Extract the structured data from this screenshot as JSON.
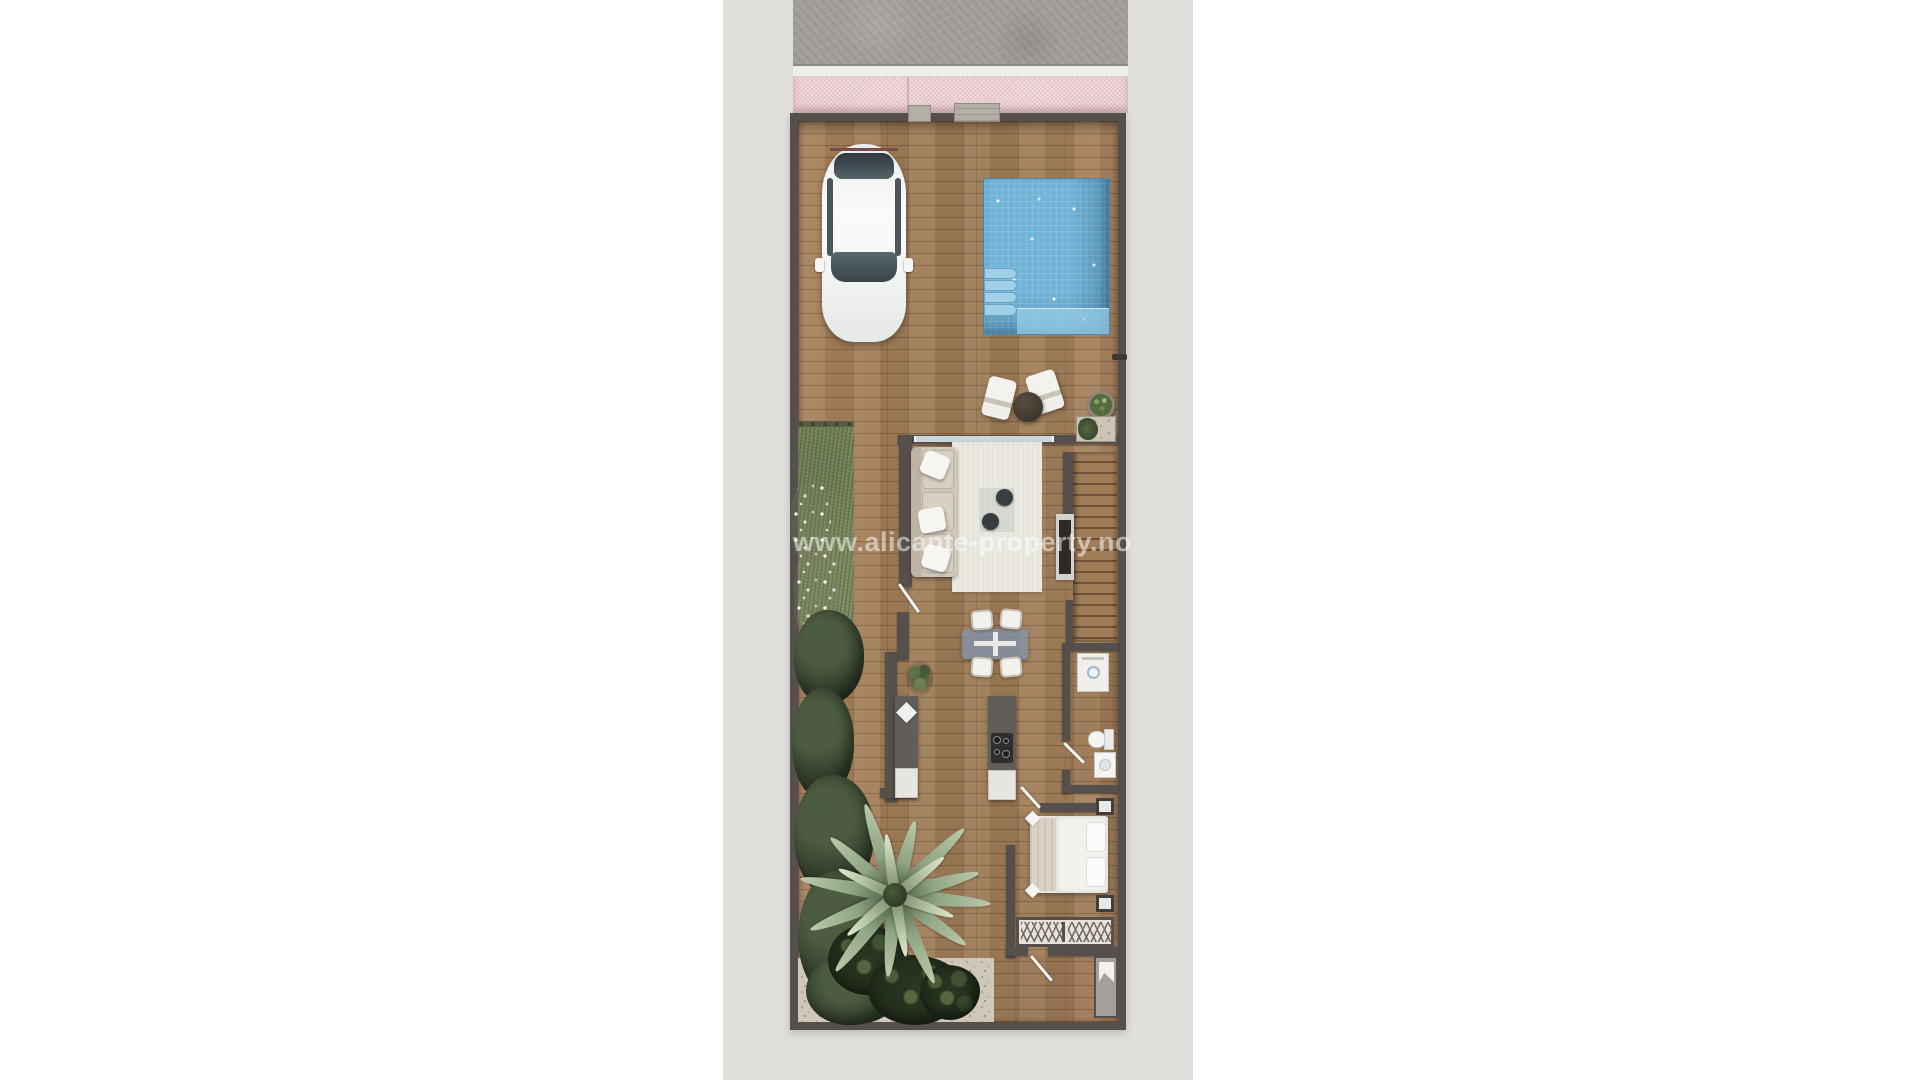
{
  "watermark": {
    "text": "www.alicante-property.no"
  },
  "colors": {
    "page_background": "#ffffff",
    "ground_strip": "#e1dfdb",
    "sidewalk_concrete": "#a29e99",
    "awning_pink": "#f3dfe3",
    "wall_dark": "#56504c",
    "deck_wood": "#a5805c",
    "pool_water": "#72b4d8",
    "pool_steps": "#9fd0e8",
    "grass": "#7d895e",
    "shrub_dark": "#2e3a26",
    "palm_leaf": "#8fa584",
    "gravel": "#cfc8ba",
    "rug": "#eae8e1",
    "sofa_beige": "#cfc7ba",
    "dining_table_blue": "#8294ab",
    "cabinet_dark": "#615d59",
    "fixture_white": "#f2f1ee",
    "car_white": "#f4f5f4",
    "glass_door": "#ccd6d8"
  },
  "elements": [
    {
      "name": "sidewalk",
      "kind": "concrete-pavement"
    },
    {
      "name": "pink-awning",
      "kind": "hatched-canopy-strip"
    },
    {
      "name": "boundary-wall",
      "kind": "dark-perimeter-wall"
    },
    {
      "name": "entrance-blocks",
      "kind": "concrete-steps-on-street-wall"
    },
    {
      "name": "car",
      "kind": "white-car-top-view"
    },
    {
      "name": "swimming-pool",
      "kind": "tiled-pool-with-corner-steps"
    },
    {
      "name": "lounge-chairs",
      "kind": "two-white-chairs-with-round-side-table"
    },
    {
      "name": "potted-plant",
      "kind": "round-planter"
    },
    {
      "name": "planter-bed",
      "kind": "gravel-planter-with-greenery"
    },
    {
      "name": "sliding-glass-door",
      "kind": "glazed-wall"
    },
    {
      "name": "sofa",
      "kind": "three-seat-sofa-with-pillows"
    },
    {
      "name": "area-rug",
      "kind": "cream-rug"
    },
    {
      "name": "coffee-table",
      "kind": "glass-table-with-two-dark-trays"
    },
    {
      "name": "tv-sideboard",
      "kind": "media-unit"
    },
    {
      "name": "staircase",
      "kind": "straight-stair-flight"
    },
    {
      "name": "washing-machine",
      "kind": "appliance-under-stairs"
    },
    {
      "name": "dining-table",
      "kind": "blue-table-with-four-chairs"
    },
    {
      "name": "kitchen-counter",
      "kind": "counter-with-sink"
    },
    {
      "name": "kitchen-island",
      "kind": "island-with-cooktop"
    },
    {
      "name": "bathroom",
      "kind": "toilet-and-vanity"
    },
    {
      "name": "bed",
      "kind": "double-bed-with-pillows"
    },
    {
      "name": "nightstands",
      "kind": "two-bedside-tables"
    },
    {
      "name": "wardrobe",
      "kind": "built-in-closet-two-sections"
    },
    {
      "name": "shower-room",
      "kind": "shower-with-towel"
    },
    {
      "name": "interior-doors",
      "kind": "open-white-door-leaves"
    },
    {
      "name": "lawn",
      "kind": "grass-strip"
    },
    {
      "name": "flower-bed",
      "kind": "white-flower-clusters"
    },
    {
      "name": "palm-tree",
      "kind": "top-view-palm"
    },
    {
      "name": "shrubs",
      "kind": "dense-dark-planting"
    },
    {
      "name": "gravel-path",
      "kind": "gravel-ground"
    }
  ]
}
